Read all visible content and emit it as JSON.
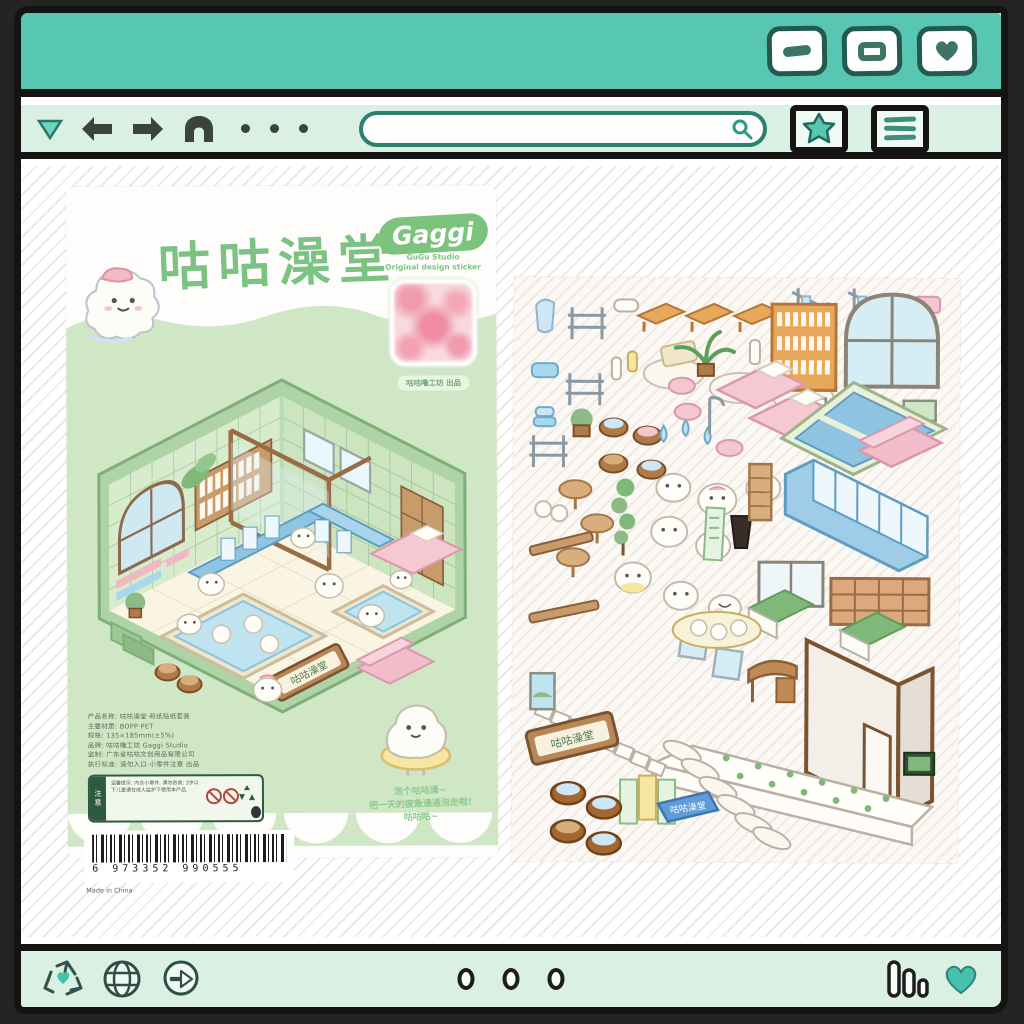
{
  "window": {
    "titlebar": {
      "controls": [
        {
          "name": "minimize-button",
          "icon": "dash-icon"
        },
        {
          "name": "maximize-button",
          "icon": "square-icon"
        },
        {
          "name": "favorite-button",
          "icon": "heart-icon"
        }
      ]
    },
    "nav": {
      "icons": [
        "dropdown-triangle-icon",
        "back-arrow-icon",
        "forward-arrow-icon",
        "home-icon"
      ],
      "dots": 3,
      "search": {
        "value": "",
        "placeholder": ""
      },
      "right_icons": [
        "bookmark-star-icon",
        "menu-icon"
      ]
    },
    "bottombar": {
      "left_icons": [
        "recycle-heart-icon",
        "globe-icon",
        "forward-circle-icon"
      ],
      "center_dots": 3,
      "right_icons": [
        "equalizer-icon",
        "heart-icon"
      ]
    }
  },
  "colors": {
    "teal": "#57c7b3",
    "mint": "#d9f0e3",
    "ink": "#141414",
    "package_green": "#cfe7c5",
    "title_green": "#7cc283",
    "pink": "#f4c7d0",
    "water_blue": "#bfe3ef",
    "wood": "#b98757"
  },
  "package": {
    "title": "咕咕澡堂",
    "mascot": "bath-blob-with-towel",
    "logo": {
      "name": "Gaggi",
      "sub1": "GuGu Studio",
      "sub2": "Original design sticker"
    },
    "sample_caption": "咕咕噜工坊 出品",
    "room_sign": "咕咕澡堂",
    "info_lines": [
      "产品名称: 咕咕澡堂·和纸贴纸套装",
      "主要材质: BOPP·PET",
      "规格: 135×185mm(±5%)",
      "品牌: 咕咕噜工坊 Gaggi Studio",
      "监制: 广东省咕咕文创用品有限公司",
      "执行标准: 请勿入口·小零件注意 出品"
    ],
    "warning_label": "注意",
    "warning_lines": "温馨提示: 内含小零件, 请勿吞食; 3岁以下儿童请在成人监护下使用本产品.",
    "barcode_display": "6 973352 990555",
    "made_in": "Made in China",
    "blurb": [
      "泡个咕咕澡~",
      "把一天的疲惫通通泡走啦!",
      "咕咕咕~"
    ]
  },
  "sticker_sheet": {
    "sign_text": "咕咕澡堂",
    "mat_text": "咕咕澡堂",
    "items": [
      "towel-hanger-blob",
      "fence",
      "soap-bar",
      "bench",
      "bench",
      "bench",
      "towel-rack",
      "towel-rack",
      "pink-case",
      "blue-sponge",
      "fence",
      "water-bottle",
      "bath-towel",
      "bath-towel",
      "bath-towel",
      "bottle-shelf",
      "arched-window",
      "photo-frame",
      "landscape-frame",
      "potted-plant",
      "wooden-bucket",
      "wooden-bucket",
      "wooden-bucket",
      "wooden-bucket",
      "bath-mat",
      "palm-plant",
      "milk-bottle",
      "pink-bed",
      "pink-bed",
      "rubber-duck",
      "water-drop",
      "water-drop",
      "water-drop",
      "pink-stool",
      "pink-stool",
      "pink-stool",
      "shower-stand",
      "blue-towel-stack",
      "round-table",
      "round-table",
      "round-table",
      "topiary-plant",
      "white-blob",
      "white-blob",
      "white-blob",
      "white-blob",
      "white-blob",
      "white-blob",
      "white-blob",
      "white-blob",
      "mirror",
      "mirror",
      "green-banner",
      "dark-vase",
      "tall-shelf",
      "big-bath-pool",
      "blue-locker-bank",
      "pink-sofa",
      "sliding-door",
      "shoe-locker",
      "counter",
      "counter",
      "vanity-desk",
      "corner-wall",
      "platform-floor",
      "lounge-chair-row",
      "ladder-strip",
      "sign-board",
      "poster",
      "poster",
      "poster",
      "barrel",
      "barrel",
      "barrel",
      "barrel",
      "blue-mat",
      "portrait-frame",
      "tv-screen",
      "bun-tray",
      "chick"
    ]
  }
}
